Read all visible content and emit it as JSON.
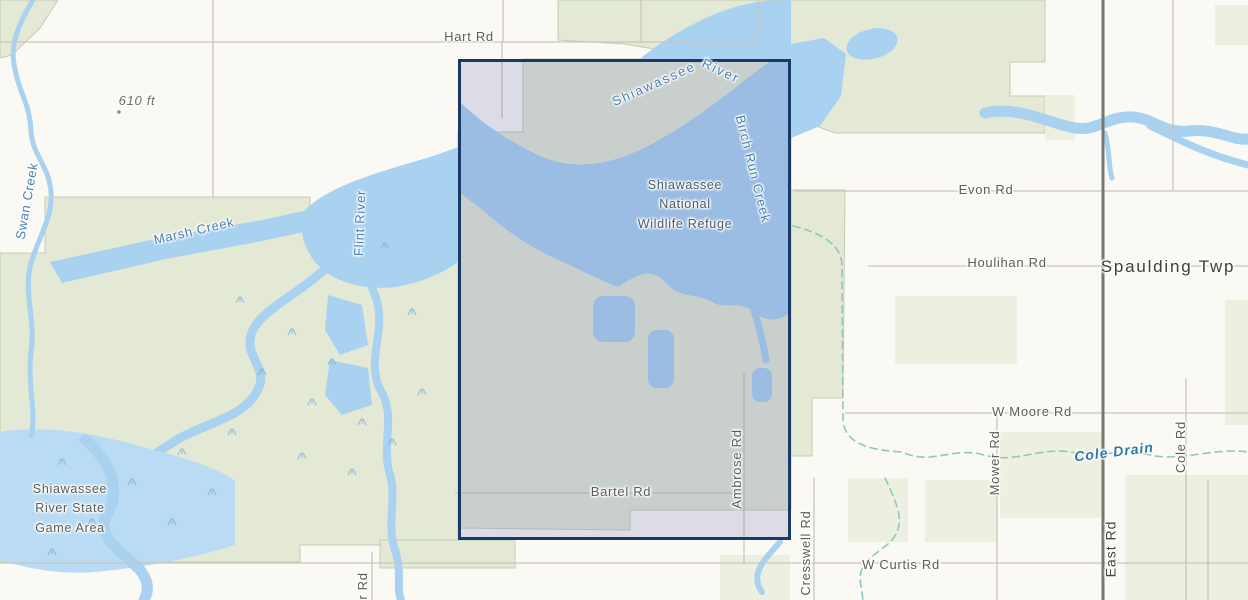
{
  "map": {
    "place_labels": {
      "hart_rd": "Hart Rd",
      "elevation_point": "610 ft",
      "swan_creek": "Swan Creek",
      "marsh_creek": "Marsh Creek",
      "flint_river": "Flint River",
      "shiawassee_river": {
        "word1": "Shiawassee",
        "word2": "River"
      },
      "birch_run_creek": "Birch Run Creek",
      "refuge": "Shiawassee National Wildlife Refuge",
      "evon_rd": "Evon Rd",
      "houlihan_rd": "Houlihan Rd",
      "spaulding_twp": "Spaulding Twp",
      "w_moore_rd": "W Moore Rd",
      "mower_rd": "Mower Rd",
      "cole_drain": "Cole Drain",
      "cole_rd": "Cole Rd",
      "ambrose_rd": "Ambrose Rd",
      "bartel_rd": "Bartel Rd",
      "state_game_area": "Shiawassee River State Game Area",
      "w_curtis_rd": "W Curtis Rd",
      "cresswell_rd": "Cresswell Rd",
      "east_rd": "East Rd",
      "partial_road": "r Rd"
    }
  },
  "colors": {
    "background": "#faf9f4",
    "vegetation_green": "#e3e9d4",
    "pale_green": "#edf0e1",
    "water_blue": "#a9d2f0",
    "wetland_blue": "#b9dcf4",
    "road_gray": "#c9c6bd",
    "major_road_gray": "#787672",
    "drain_teal": "#8fc7c2",
    "road_label_gray": "#5c5c58",
    "water_label_blue": "#4a80b2",
    "drain_label_blue": "#2d7aa7",
    "town_label_gray": "#3d3d3b",
    "refuge_label_gray": "#4d5965",
    "selection_border_navy": "#1a3a66",
    "selection_fill": "rgba(100,104,176,0.20)",
    "boundary_green": "#c6cdb6"
  }
}
